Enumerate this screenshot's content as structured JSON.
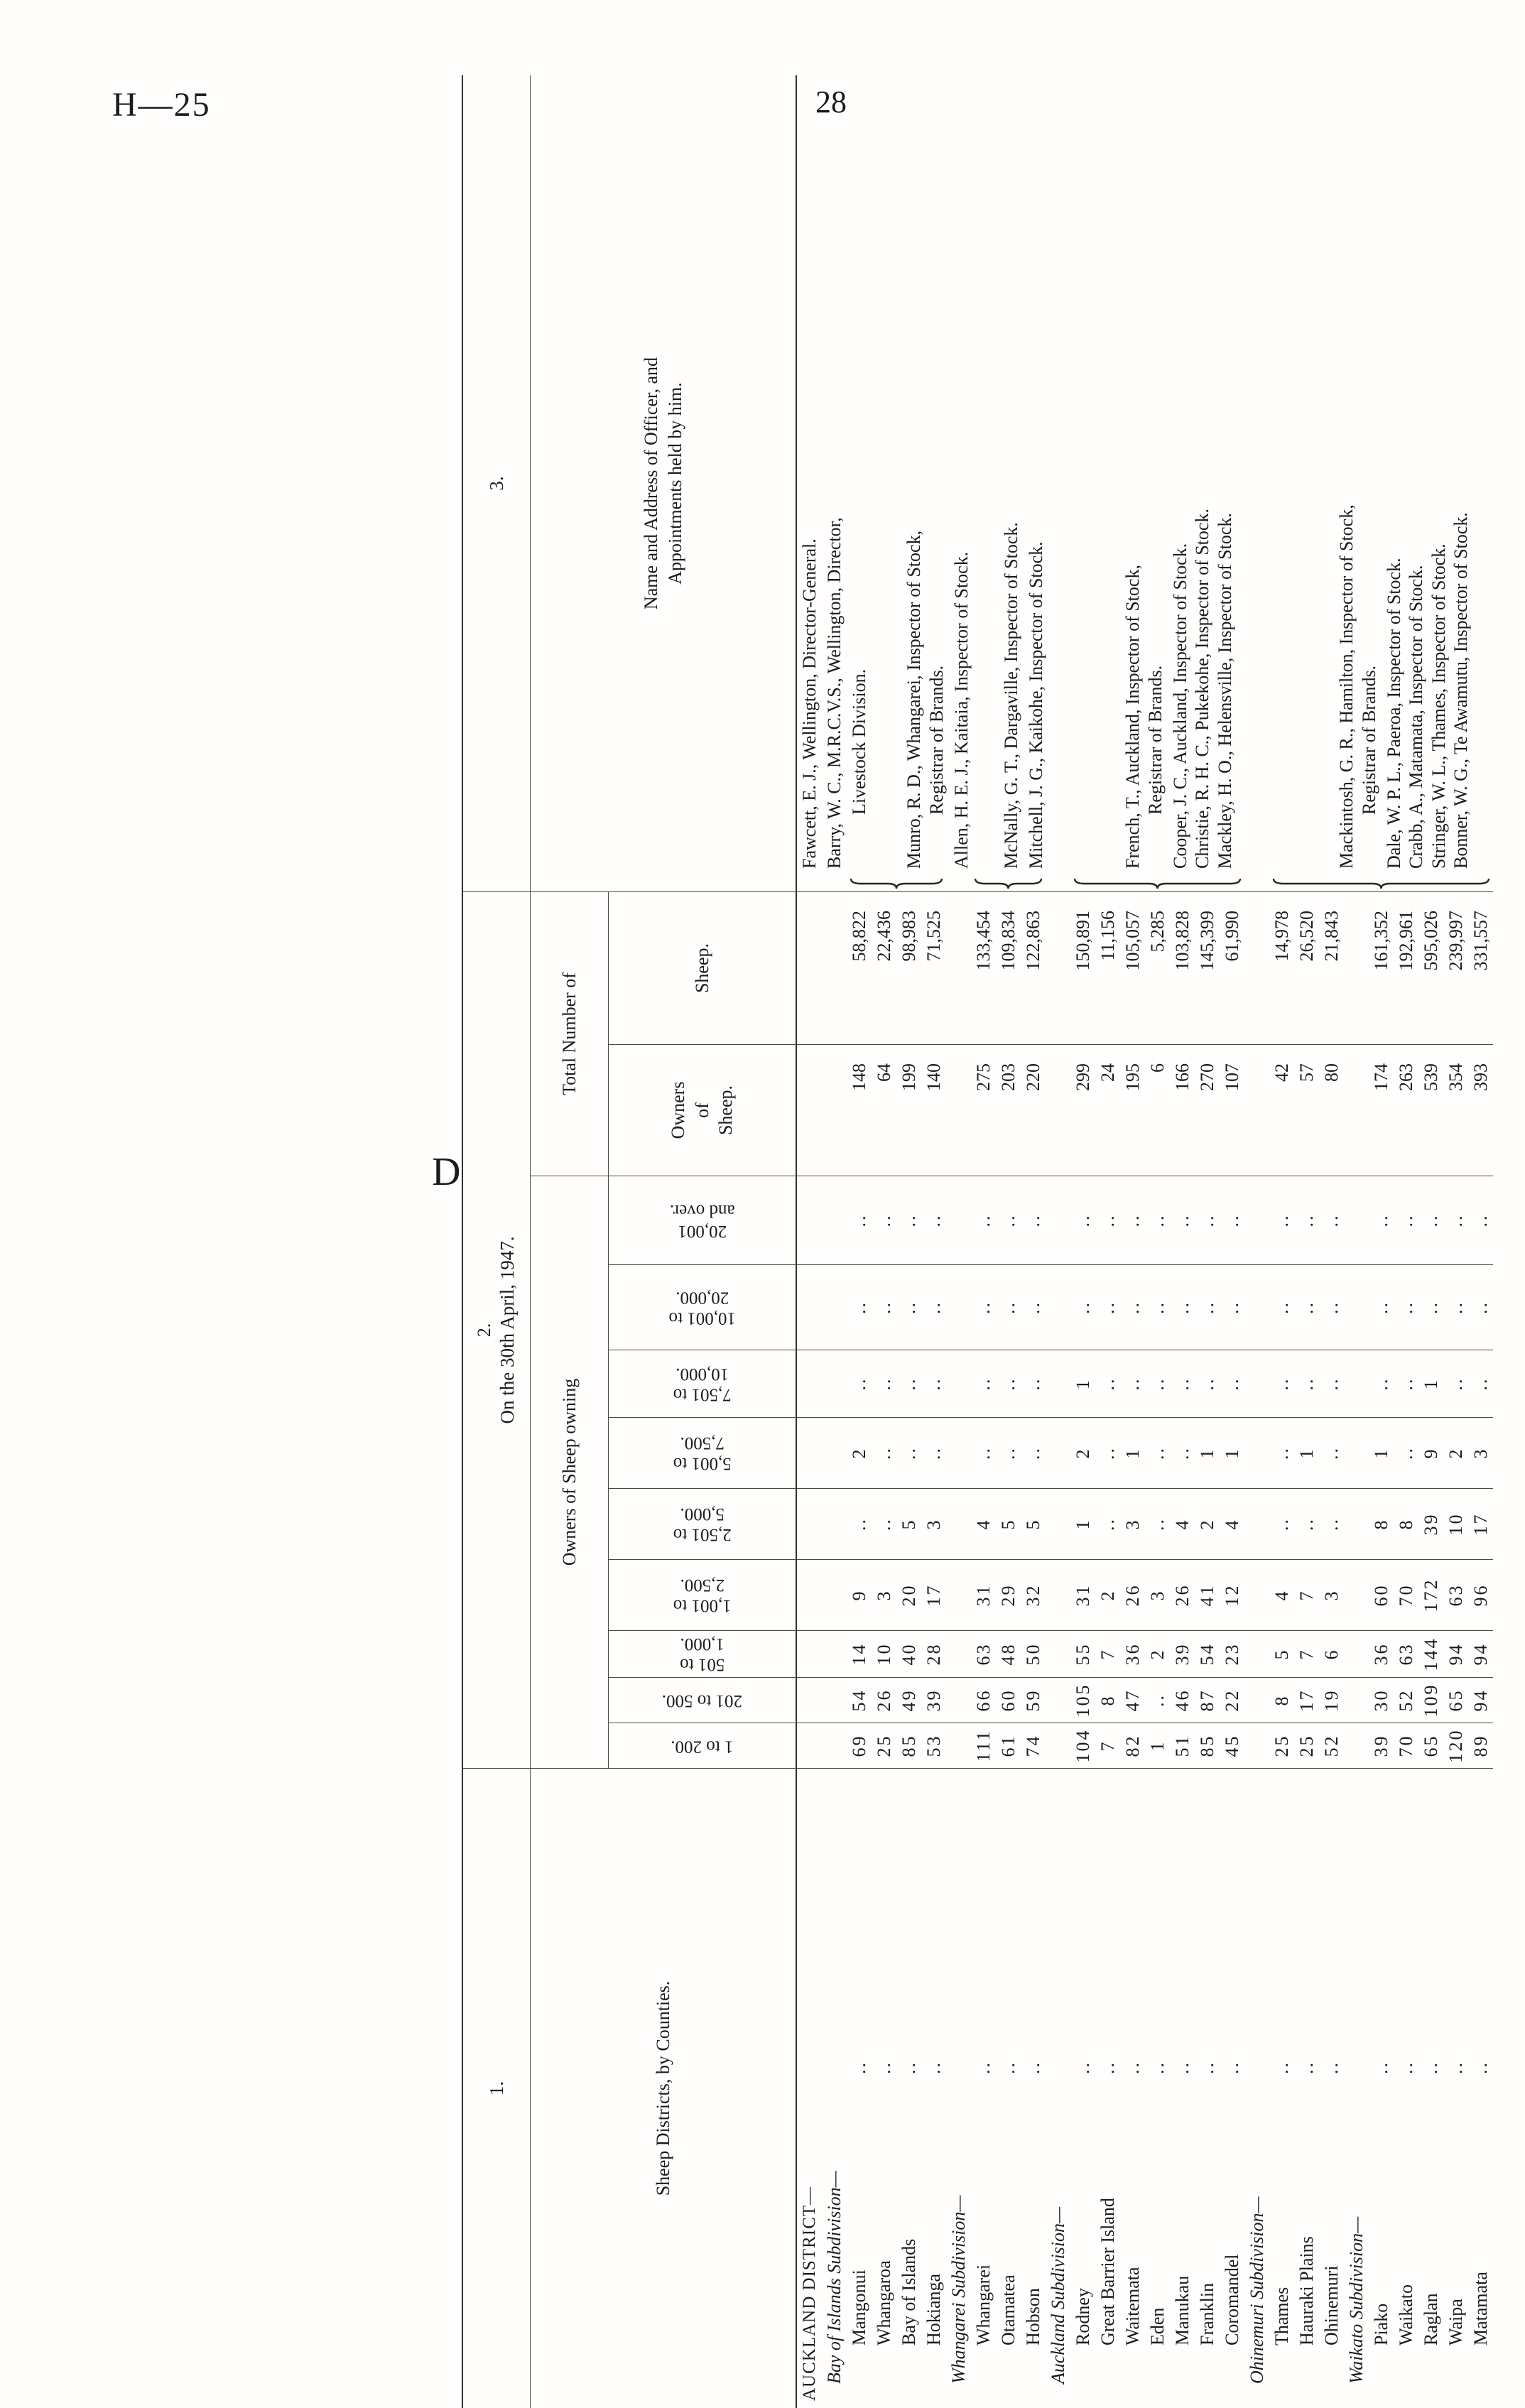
{
  "page": {
    "doc_ref": "H—25",
    "page_number": "28",
    "signature_mark": "D"
  },
  "table": {
    "section_labels": {
      "col1": "1.",
      "col2": "2.",
      "col3": "3."
    },
    "title_date": "On the 30th April, 1947.",
    "headers": {
      "counties": "Sheep Districts, by Counties.",
      "owners_group": "Owners of Sheep owning",
      "ranges": [
        "1 to 200.",
        "201 to 500.",
        "501 to\n1,000.",
        "1,001 to\n2,500.",
        "2,501 to\n5,000.",
        "5,001 to\n7,500.",
        "7,501 to\n10,000.",
        "10,001 to\n20,000.",
        "20,001\nand over."
      ],
      "total_group": "Total Number of",
      "total_owners": "Owners\nof\nSheep.",
      "total_sheep": "Sheep.",
      "officer": "Name and Address of Officer, and\nAppointments held by him."
    },
    "leader_dots": "..",
    "rows": [
      {
        "type": "district",
        "label": "AUCKLAND DISTRICT—"
      },
      {
        "type": "subdivision",
        "label": "Bay of Islands Subdivision—"
      },
      {
        "type": "county",
        "label": "Mangonui",
        "values": [
          "69",
          "54",
          "14",
          "9",
          "..",
          "2",
          "..",
          "..",
          ".."
        ],
        "owners": "148",
        "sheep": "58,822"
      },
      {
        "type": "county",
        "label": "Whangaroa",
        "values": [
          "25",
          "26",
          "10",
          "3",
          "..",
          "..",
          "..",
          "..",
          ".."
        ],
        "owners": "64",
        "sheep": "22,436"
      },
      {
        "type": "county",
        "label": "Bay of Islands",
        "values": [
          "85",
          "49",
          "40",
          "20",
          "5",
          "..",
          "..",
          "..",
          ".."
        ],
        "owners": "199",
        "sheep": "98,983"
      },
      {
        "type": "county",
        "label": "Hokianga",
        "values": [
          "53",
          "39",
          "28",
          "17",
          "3",
          "..",
          "..",
          "..",
          ".."
        ],
        "owners": "140",
        "sheep": "71,525"
      },
      {
        "type": "subdivision",
        "label": "Whangarei Subdivision—"
      },
      {
        "type": "county",
        "label": "Whangarei",
        "values": [
          "111",
          "66",
          "63",
          "31",
          "4",
          "..",
          "..",
          "..",
          ".."
        ],
        "owners": "275",
        "sheep": "133,454"
      },
      {
        "type": "county",
        "label": "Otamatea",
        "values": [
          "61",
          "60",
          "48",
          "29",
          "5",
          "..",
          "..",
          "..",
          ".."
        ],
        "owners": "203",
        "sheep": "109,834"
      },
      {
        "type": "county",
        "label": "Hobson",
        "values": [
          "74",
          "59",
          "50",
          "32",
          "5",
          "..",
          "..",
          "..",
          ".."
        ],
        "owners": "220",
        "sheep": "122,863"
      },
      {
        "type": "subdivision",
        "label": "Auckland Subdivision—"
      },
      {
        "type": "county",
        "label": "Rodney",
        "values": [
          "104",
          "105",
          "55",
          "31",
          "1",
          "2",
          "1",
          "..",
          ".."
        ],
        "owners": "299",
        "sheep": "150,891"
      },
      {
        "type": "county",
        "label": "Great Barrier Island",
        "values": [
          "7",
          "8",
          "7",
          "2",
          "..",
          "..",
          "..",
          "..",
          ".."
        ],
        "owners": "24",
        "sheep": "11,156"
      },
      {
        "type": "county",
        "label": "Waitemata",
        "values": [
          "82",
          "47",
          "36",
          "26",
          "3",
          "1",
          "..",
          "..",
          ".."
        ],
        "owners": "195",
        "sheep": "105,057"
      },
      {
        "type": "county",
        "label": "Eden",
        "values": [
          "1",
          "..",
          "2",
          "3",
          "..",
          "..",
          "..",
          "..",
          ".."
        ],
        "owners": "6",
        "sheep": "5,285"
      },
      {
        "type": "county",
        "label": "Manukau",
        "values": [
          "51",
          "46",
          "39",
          "26",
          "4",
          "..",
          "..",
          "..",
          ".."
        ],
        "owners": "166",
        "sheep": "103,828"
      },
      {
        "type": "county",
        "label": "Franklin",
        "values": [
          "85",
          "87",
          "54",
          "41",
          "2",
          "1",
          "..",
          "..",
          ".."
        ],
        "owners": "270",
        "sheep": "145,399"
      },
      {
        "type": "county",
        "label": "Coromandel",
        "values": [
          "45",
          "22",
          "23",
          "12",
          "4",
          "1",
          "..",
          "..",
          ".."
        ],
        "owners": "107",
        "sheep": "61,990"
      },
      {
        "type": "subdivision",
        "label": "Ohinemuri Subdivision—"
      },
      {
        "type": "county",
        "label": "Thames",
        "values": [
          "25",
          "8",
          "5",
          "4",
          "..",
          "..",
          "..",
          "..",
          ".."
        ],
        "owners": "42",
        "sheep": "14,978"
      },
      {
        "type": "county",
        "label": "Hauraki Plains",
        "values": [
          "25",
          "17",
          "7",
          "7",
          "..",
          "1",
          "..",
          "..",
          ".."
        ],
        "owners": "57",
        "sheep": "26,520"
      },
      {
        "type": "county",
        "label": "Ohinemuri",
        "values": [
          "52",
          "19",
          "6",
          "3",
          "..",
          "..",
          "..",
          "..",
          ".."
        ],
        "owners": "80",
        "sheep": "21,843"
      },
      {
        "type": "subdivision",
        "label": "Waikato Subdivision—"
      },
      {
        "type": "county",
        "label": "Piako",
        "values": [
          "39",
          "30",
          "36",
          "60",
          "8",
          "1",
          "..",
          "..",
          ".."
        ],
        "owners": "174",
        "sheep": "161,352"
      },
      {
        "type": "county",
        "label": "Waikato",
        "values": [
          "70",
          "52",
          "63",
          "70",
          "8",
          "..",
          "..",
          "..",
          ".."
        ],
        "owners": "263",
        "sheep": "192,961"
      },
      {
        "type": "county",
        "label": "Raglan",
        "values": [
          "65",
          "109",
          "144",
          "172",
          "39",
          "9",
          "1",
          "..",
          ".."
        ],
        "owners": "539",
        "sheep": "595,026"
      },
      {
        "type": "county",
        "label": "Waipa",
        "values": [
          "120",
          "65",
          "94",
          "63",
          "10",
          "2",
          "..",
          "..",
          ".."
        ],
        "owners": "354",
        "sheep": "239,997"
      },
      {
        "type": "county",
        "label": "Matamata",
        "values": [
          "89",
          "94",
          "94",
          "96",
          "17",
          "3",
          "..",
          "..",
          ".."
        ],
        "owners": "393",
        "sheep": "331,557"
      }
    ],
    "officers": [
      {
        "text": "Fawcett, E. J., Wellington, Director-General.",
        "row": 0
      },
      {
        "text": "Barry, W. C., M.R.C.V.S., Wellington, Director,",
        "row": 1
      },
      {
        "text": "Livestock Division.",
        "row": 2,
        "indent": true
      },
      {
        "text": "Munro, R. D., Whangarei, Inspector of Stock,",
        "row": 4.2
      },
      {
        "text": "Registrar of Brands.",
        "row": 5.1,
        "indent": true
      },
      {
        "text": "Allen, H. E. J., Kaitaia, Inspector of Stock.",
        "row": 6.1
      },
      {
        "text": "McNally, G. T., Dargaville, Inspector of Stock.",
        "row": 8.1
      },
      {
        "text": "Mitchell, J. G., Kaikohe, Inspector of Stock.",
        "row": 9.1
      },
      {
        "text": "French, T., Auckland, Inspector of Stock,",
        "row": 13
      },
      {
        "text": "Registrar of Brands.",
        "row": 13.9,
        "indent": true
      },
      {
        "text": "Cooper, J. C., Auckland, Inspector of Stock.",
        "row": 14.9
      },
      {
        "text": "Christie, R. H. C., Pukekohe, Inspector of Stock.",
        "row": 15.8
      },
      {
        "text": "Mackley, H. O., Helensville, Inspector of Stock.",
        "row": 16.7
      },
      {
        "text": "Mackintosh, G. R., Hamilton, Inspector of Stock,",
        "row": 21.6
      },
      {
        "text": "Registrar of Brands.",
        "row": 22.5,
        "indent": true
      },
      {
        "text": "Dale, W. P. L., Paeroa, Inspector of Stock.",
        "row": 23.5
      },
      {
        "text": "Crabb, A., Matamata, Inspector of Stock.",
        "row": 24.4
      },
      {
        "text": "Stringer, W. L., Thames, Inspector of Stock.",
        "row": 25.3
      },
      {
        "text": "Bonner, W. G., Te Awamutu, Inspector of Stock.",
        "row": 26.2
      }
    ],
    "braces": [
      {
        "from": 2,
        "to": 6
      },
      {
        "from": 7,
        "to": 10
      },
      {
        "from": 11,
        "to": 18
      },
      {
        "from": 19,
        "to": 28
      }
    ]
  }
}
